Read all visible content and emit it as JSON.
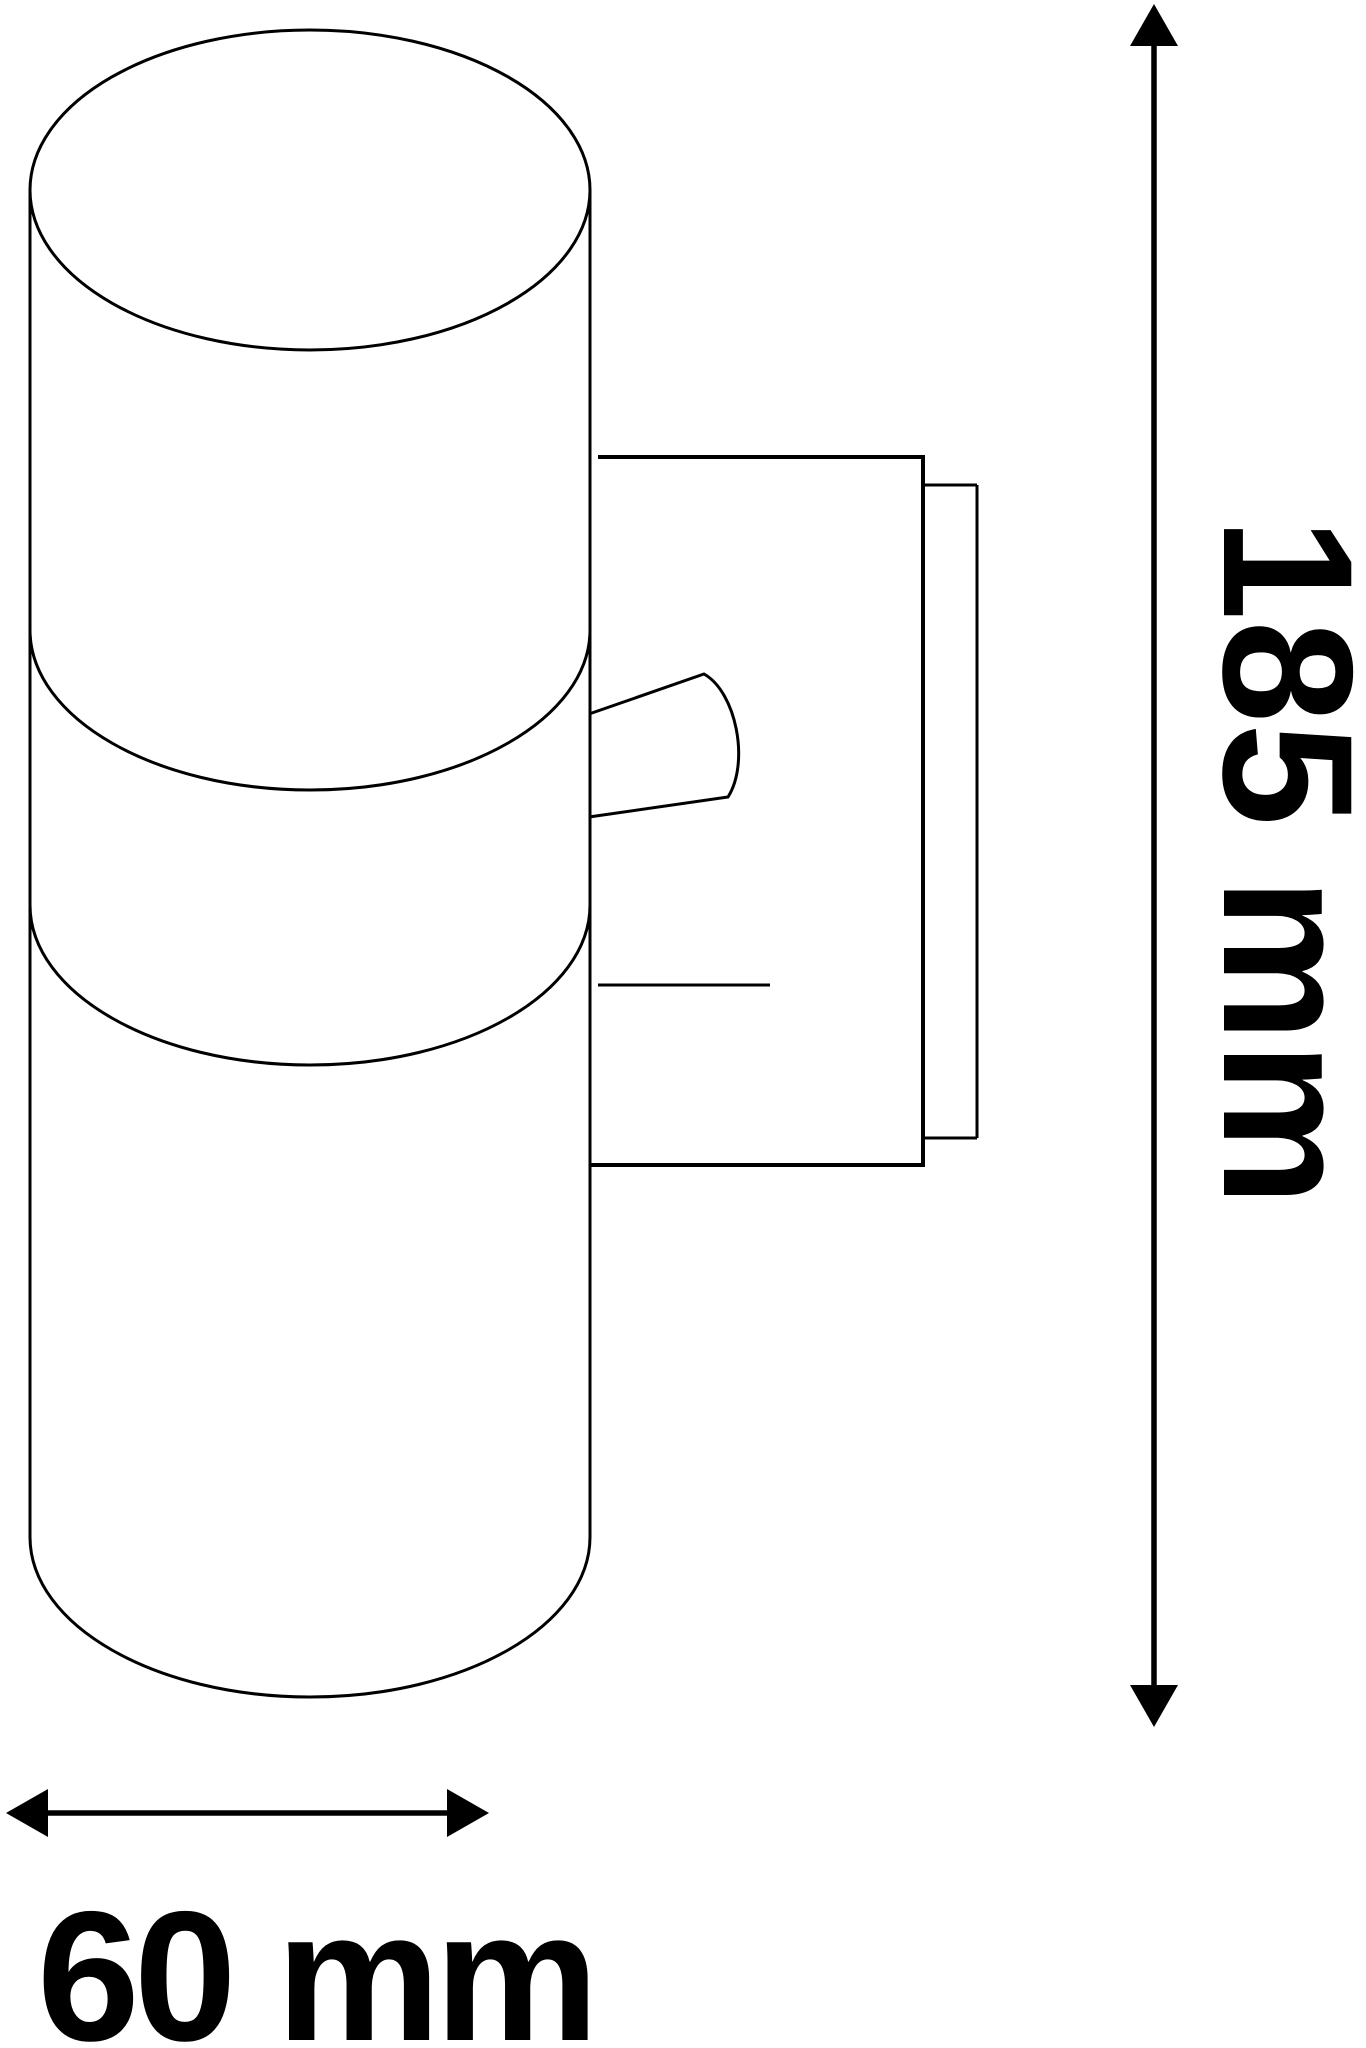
{
  "diagram": {
    "height_label": "185 mm",
    "width_label": "60 mm",
    "line_color": "#000000",
    "background_color": "#ffffff"
  }
}
